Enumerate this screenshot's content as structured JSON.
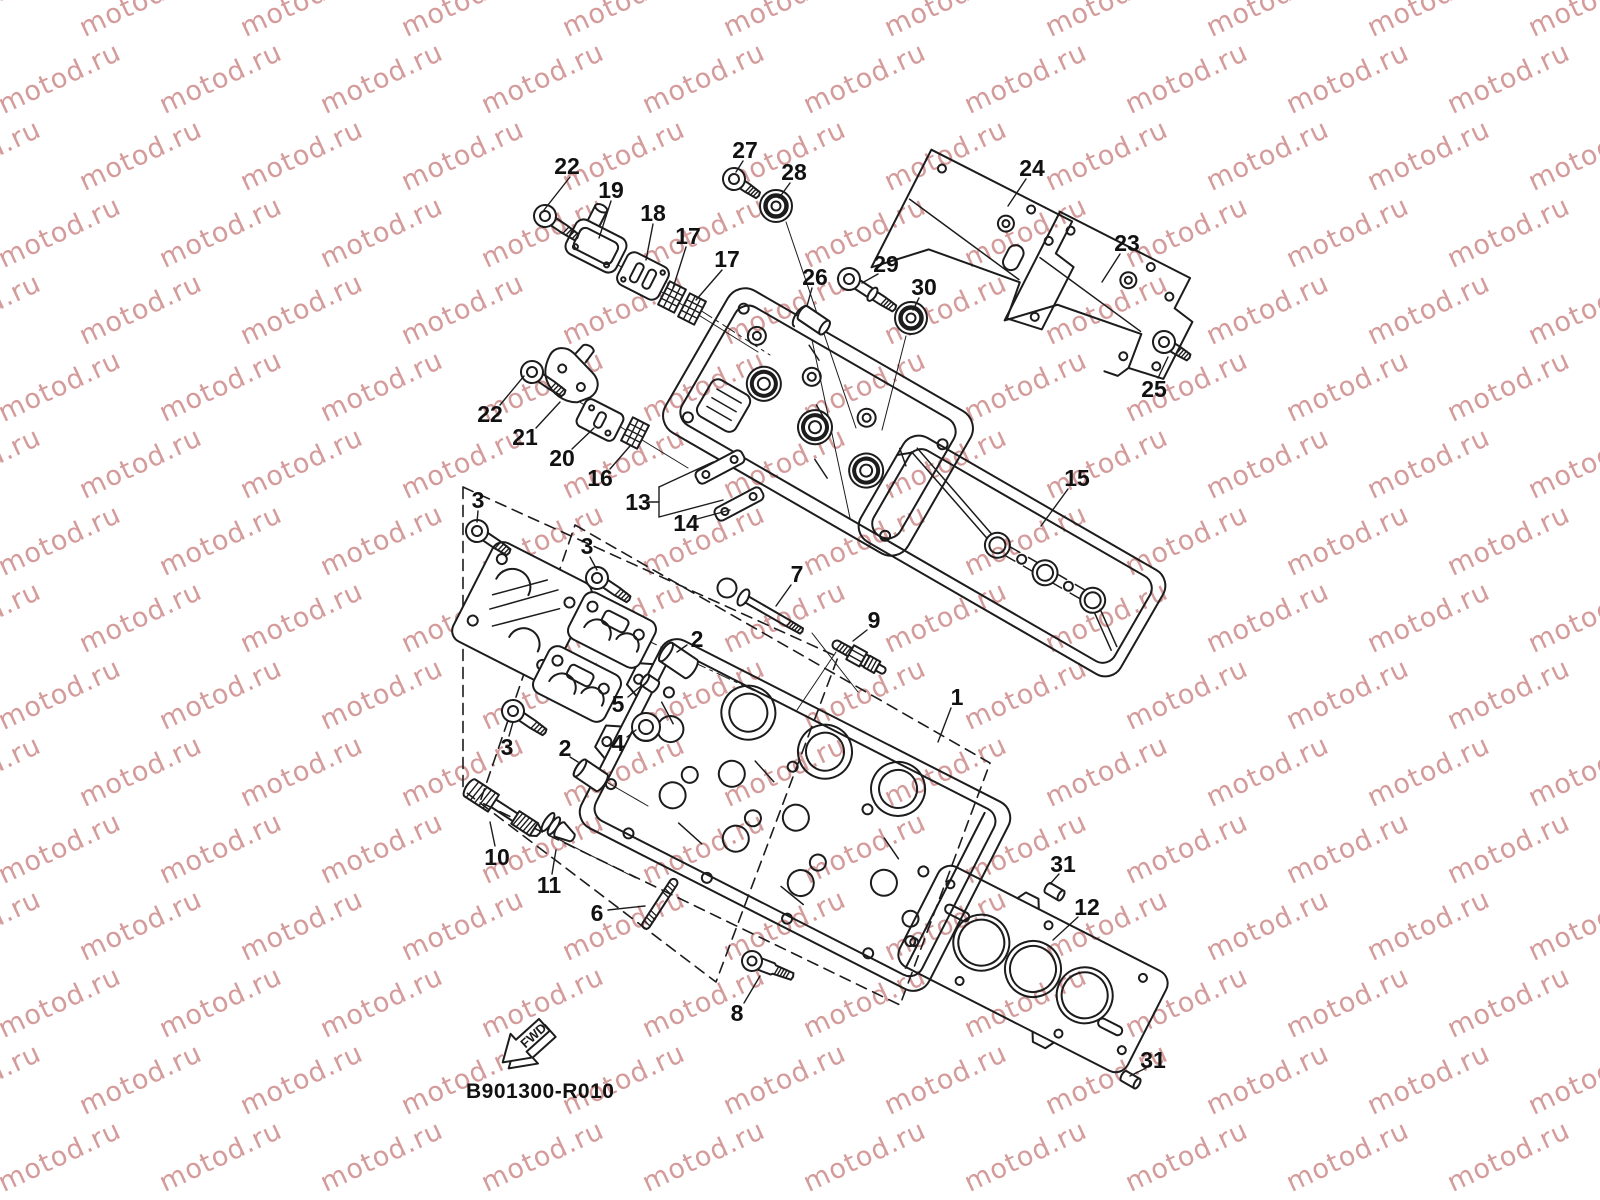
{
  "figure": {
    "code": "B901300-R010"
  },
  "fwd": {
    "label": "FWD"
  },
  "watermark": {
    "text": "motod.ru",
    "color": "rgba(205,138,138,0.85)",
    "font_size": 27,
    "rotation_deg": -25,
    "step_x": 161,
    "step_y": 77,
    "row_offset_x": 80,
    "rows": 16
  },
  "style": {
    "line_color": "#1c1c1c",
    "label_color": "#111111"
  },
  "callouts": [
    {
      "label": "22",
      "x": 567,
      "y": 166,
      "leader": [
        570,
        177,
        544,
        210
      ]
    },
    {
      "label": "19",
      "x": 611,
      "y": 190,
      "leader": [
        611,
        201,
        599,
        238
      ]
    },
    {
      "label": "18",
      "x": 653,
      "y": 213,
      "leader": [
        653,
        224,
        646,
        260
      ]
    },
    {
      "label": "17",
      "x": 688,
      "y": 236,
      "leader": [
        686,
        247,
        673,
        288
      ]
    },
    {
      "label": "17",
      "x": 727,
      "y": 259,
      "leader": [
        722,
        270,
        696,
        300
      ]
    },
    {
      "label": "27",
      "x": 745,
      "y": 150,
      "leader": [
        743,
        161,
        736,
        172
      ]
    },
    {
      "label": "28",
      "x": 794,
      "y": 172,
      "leader": [
        790,
        183,
        779,
        198
      ]
    },
    {
      "label": "26",
      "x": 815,
      "y": 277,
      "leader": [
        812,
        288,
        807,
        306
      ]
    },
    {
      "label": "29",
      "x": 886,
      "y": 264,
      "leader": [
        878,
        274,
        862,
        283
      ]
    },
    {
      "label": "30",
      "x": 924,
      "y": 287,
      "leader": [
        919,
        298,
        913,
        310
      ]
    },
    {
      "label": "24",
      "x": 1032,
      "y": 168,
      "leader": [
        1026,
        179,
        1008,
        206
      ]
    },
    {
      "label": "23",
      "x": 1127,
      "y": 243,
      "leader": [
        1120,
        254,
        1102,
        282
      ]
    },
    {
      "label": "25",
      "x": 1154,
      "y": 389,
      "leader": [
        1158,
        378,
        1168,
        357
      ]
    },
    {
      "label": "22",
      "x": 490,
      "y": 414,
      "leader": [
        500,
        405,
        524,
        376
      ]
    },
    {
      "label": "21",
      "x": 525,
      "y": 437,
      "leader": [
        536,
        428,
        560,
        402
      ]
    },
    {
      "label": "20",
      "x": 562,
      "y": 458,
      "leader": [
        572,
        449,
        594,
        428
      ]
    },
    {
      "label": "16",
      "x": 600,
      "y": 478,
      "leader": [
        610,
        469,
        630,
        446
      ]
    },
    {
      "label": "13",
      "x": 638,
      "y": 502,
      "leader": [
        648,
        502,
        659,
        502
      ]
    },
    {
      "label": "14",
      "x": 686,
      "y": 523,
      "leader": [
        697,
        519,
        730,
        510
      ]
    },
    {
      "label": "15",
      "x": 1077,
      "y": 478,
      "leader": [
        1068,
        489,
        1041,
        526
      ]
    },
    {
      "label": "3",
      "x": 478,
      "y": 500,
      "leader": [
        478,
        511,
        477,
        522
      ]
    },
    {
      "label": "3",
      "x": 587,
      "y": 546,
      "leader": [
        590,
        557,
        597,
        570
      ]
    },
    {
      "label": "3",
      "x": 507,
      "y": 747,
      "leader": [
        509,
        736,
        513,
        722
      ]
    },
    {
      "label": "7",
      "x": 797,
      "y": 574,
      "leader": [
        791,
        585,
        776,
        606
      ]
    },
    {
      "label": "9",
      "x": 874,
      "y": 620,
      "leader": [
        867,
        630,
        853,
        641
      ]
    },
    {
      "label": "2",
      "x": 697,
      "y": 639,
      "leader": [
        687,
        645,
        677,
        652
      ]
    },
    {
      "label": "2",
      "x": 565,
      "y": 748,
      "leader": [
        570,
        757,
        578,
        762
      ]
    },
    {
      "label": "5",
      "x": 618,
      "y": 704,
      "leader": [
        628,
        697,
        641,
        686
      ]
    },
    {
      "label": "4",
      "x": 618,
      "y": 743,
      "leader": [
        627,
        737,
        636,
        730
      ]
    },
    {
      "label": "1",
      "x": 957,
      "y": 697,
      "leader": [
        951,
        708,
        938,
        742
      ]
    },
    {
      "label": "10",
      "x": 497,
      "y": 857,
      "leader": [
        495,
        846,
        490,
        822
      ]
    },
    {
      "label": "11",
      "x": 549,
      "y": 885,
      "leader": [
        552,
        874,
        556,
        850
      ]
    },
    {
      "label": "6",
      "x": 597,
      "y": 913,
      "leader": [
        608,
        910,
        645,
        906
      ]
    },
    {
      "label": "8",
      "x": 737,
      "y": 1013,
      "leader": [
        744,
        1003,
        760,
        976
      ]
    },
    {
      "label": "12",
      "x": 1087,
      "y": 907,
      "leader": [
        1078,
        917,
        1053,
        940
      ]
    },
    {
      "label": "31",
      "x": 1063,
      "y": 864,
      "leader": [
        1059,
        874,
        1050,
        884
      ]
    },
    {
      "label": "31",
      "x": 1153,
      "y": 1060,
      "leader": [
        1146,
        1068,
        1130,
        1076
      ]
    }
  ],
  "bracket_lines": [
    [
      659,
      487,
      659,
      517
    ],
    [
      659,
      487,
      713,
      462
    ],
    [
      659,
      517,
      723,
      500
    ]
  ]
}
